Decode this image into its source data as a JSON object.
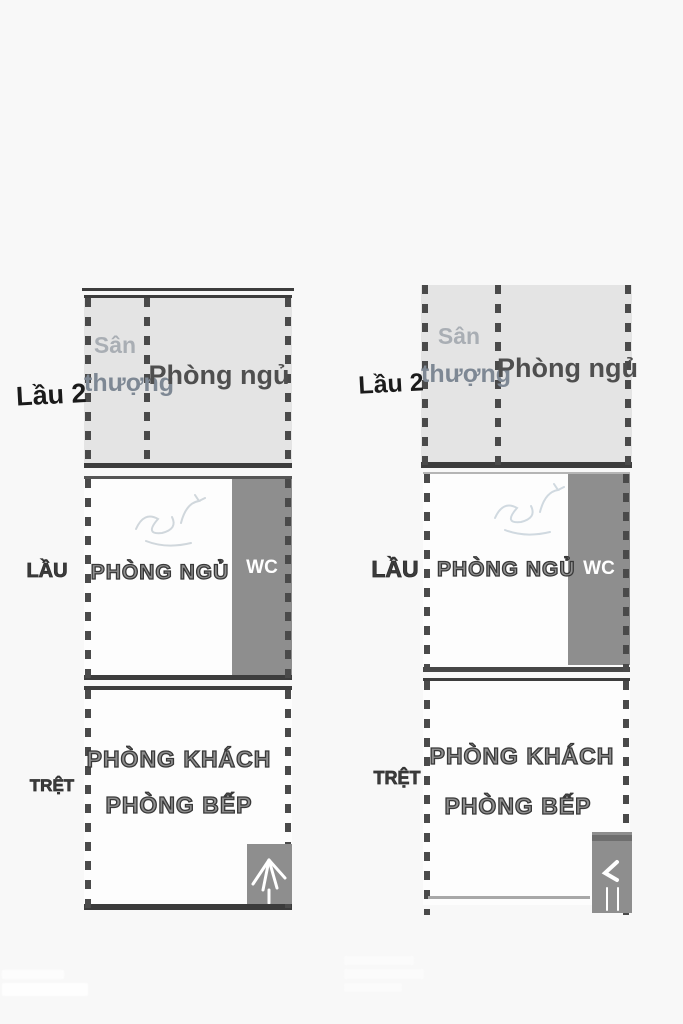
{
  "image_kind": "rotated floor plan photo, duplicated side by side",
  "colors": {
    "background": "#f8f8f8",
    "terrace_fill": "#e4e4e4",
    "room_fill": "#fdfdfd",
    "block_fill": "#8e8e8e",
    "wall_line": "#3d3d3d",
    "dash": "#4a4a4a",
    "terrace_text": "#7e8894",
    "bedroom_text": "#4f4f4f",
    "wc_text": "#ffffff"
  },
  "plans": [
    {
      "id": "left",
      "floor2_label": "Lầu 2",
      "terrace_line1": "Sân",
      "terrace_line2": "thượng",
      "bedroom_upper": "Phòng ngủ",
      "floor1_label": "LẦU",
      "bedroom": "PHÒNG NGỦ",
      "wc": "WC",
      "ground_label": "TRỆT",
      "living_room": "PHÒNG KHÁCH",
      "kitchen": "PHÒNG BẾP"
    },
    {
      "id": "right",
      "floor2_label": "Lầu 2",
      "terrace_line1": "Sân",
      "terrace_line2": "thượng",
      "bedroom_upper": "Phòng ngủ",
      "floor1_label": "LẦU",
      "bedroom": "PHÒNG NGỦ",
      "wc": "WC",
      "ground_label": "TRỆT",
      "living_room": "PHÒNG KHÁCH",
      "kitchen": "PHÒNG BẾP"
    }
  ],
  "watermarks": {
    "count": 2,
    "legible": false,
    "color": "#ffffff",
    "positions": [
      "bottom-left",
      "bottom-center"
    ]
  }
}
